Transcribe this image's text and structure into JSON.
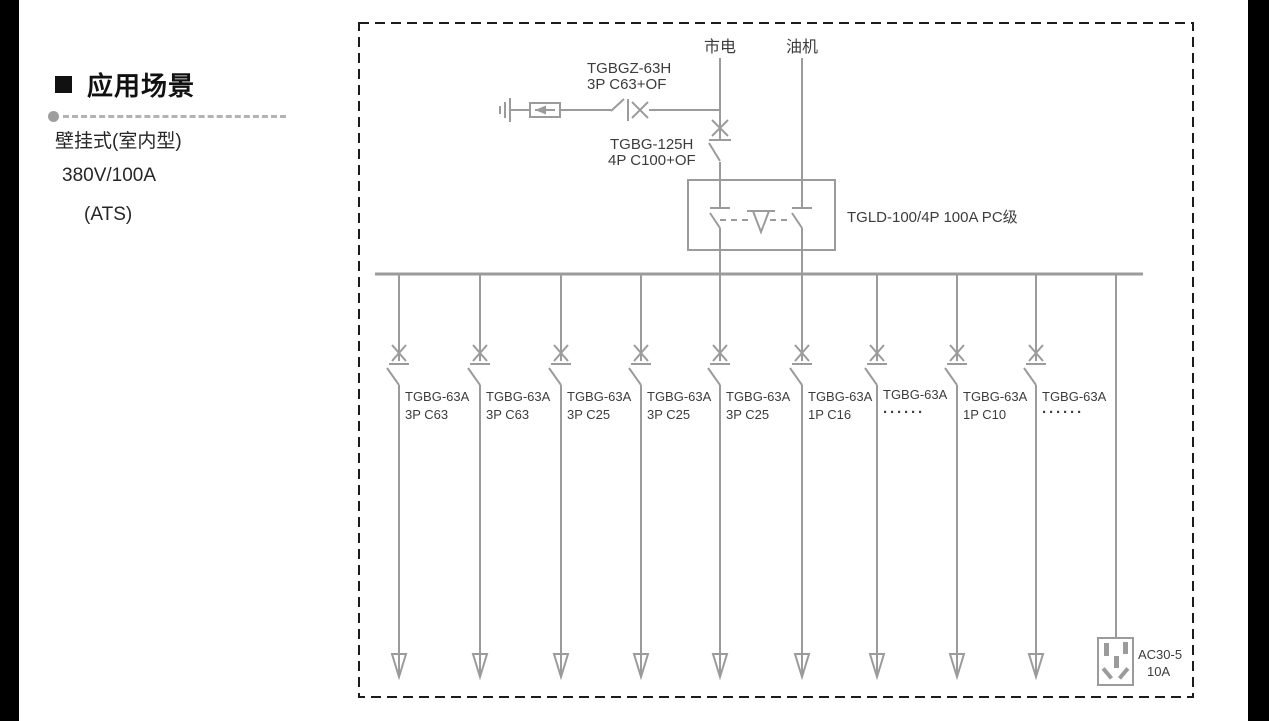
{
  "colors": {
    "diagram_line": "#9b9b9b",
    "diagram_text": "#3c3c3c",
    "dashed_border": "#1c1c1c",
    "sidebar_text": "#262626",
    "separator": "#b3b3b3",
    "crop_bars": "#000000"
  },
  "sidebar": {
    "heading": "应用场景",
    "specs": [
      "壁挂式(室内型)",
      "380V/100A",
      "(ATS)"
    ]
  },
  "diagram": {
    "source_mains": "市电",
    "source_generator": "油机",
    "spd_breaker": {
      "model": "TGBGZ-63H",
      "spec": "3P C63+OF"
    },
    "main_breaker": {
      "model": "TGBG-125H",
      "spec": "4P C100+OF"
    },
    "ats_label": "TGLD-100/4P 100A PC级",
    "branches": [
      {
        "model": "TGBG-63A",
        "spec": "3P C63"
      },
      {
        "model": "TGBG-63A",
        "spec": "3P C63"
      },
      {
        "model": "TGBG-63A",
        "spec": "3P C25"
      },
      {
        "model": "TGBG-63A",
        "spec": "3P C25"
      },
      {
        "model": "TGBG-63A",
        "spec": "3P C25"
      },
      {
        "model": "TGBG-63A",
        "spec": "1P C16"
      },
      {
        "model": "TGBG-63A",
        "spec": "······"
      },
      {
        "model": "TGBG-63A",
        "spec": "1P C10"
      },
      {
        "model": "TGBG-63A",
        "spec": "······"
      }
    ],
    "socket": {
      "model": "AC30-5",
      "rating": "10A"
    }
  }
}
